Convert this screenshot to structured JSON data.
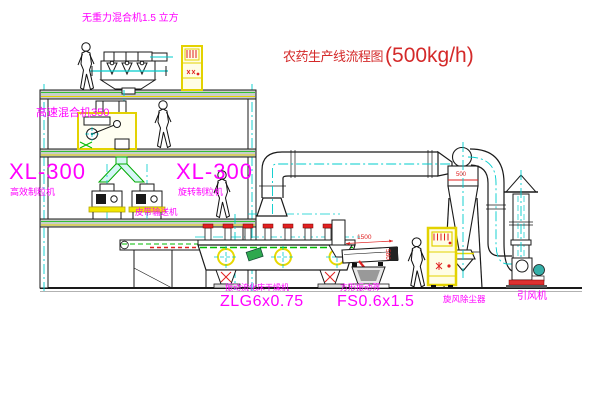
{
  "title": {
    "zh": "农药生产线流程图",
    "rate": "(500kg/h)"
  },
  "labels": {
    "top_mixer": "无重力混合机1.5 立方",
    "high_speed_mixer": "高速混合机350",
    "xl300_left": "XL-300",
    "granulator_left": "高效制粒机",
    "xl300_right": "XL-300",
    "granulator_right": "旋转制粒机",
    "belt_conveyor": "皮带输送机",
    "dryer_name": "振动流化床干燥机",
    "dryer_model": "ZLG6x0.75",
    "screen_name": "方形振动筛",
    "screen_model": "FS0.6x1.5",
    "cyclone": "旋风除尘器",
    "fan": "引风机"
  },
  "dimensions": {
    "screen_length": "1500",
    "screen_height": "580",
    "cyclone_line": "500"
  },
  "colors": {
    "label_magenta": "#FF00FF",
    "title_red": "#D42A2A",
    "machine_yellow": "#E3D200",
    "line_green": "#00BB00",
    "centerline_cyan": "#00CCCC",
    "mark_red": "#E02020"
  }
}
